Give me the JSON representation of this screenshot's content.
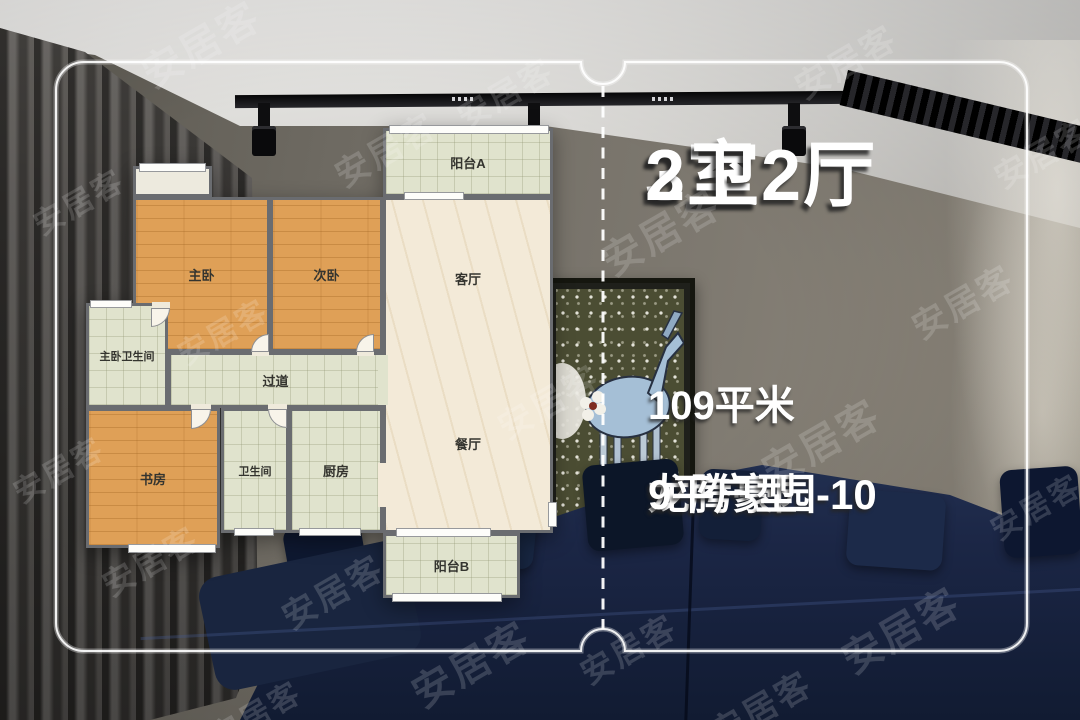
{
  "listing": {
    "title_line1": "3室2厅",
    "title_line2": "2卫",
    "area": "109平米",
    "estate_name_line1": "龙腾豪园-10",
    "estate_name_line2": "9平户型",
    "full_name": "龙腾豪园-109平户型"
  },
  "floorplan": {
    "rooms": [
      {
        "id": "balcony-a",
        "label": "阳台A"
      },
      {
        "id": "living-room",
        "label": "客厅"
      },
      {
        "id": "dining-room",
        "label": "餐厅"
      },
      {
        "id": "master-bedroom",
        "label": "主卧"
      },
      {
        "id": "second-bedroom",
        "label": "次卧"
      },
      {
        "id": "master-bathroom",
        "label": "主卧卫生间"
      },
      {
        "id": "hallway",
        "label": "过道"
      },
      {
        "id": "study",
        "label": "书房"
      },
      {
        "id": "bathroom",
        "label": "卫生间"
      },
      {
        "id": "kitchen",
        "label": "厨房"
      },
      {
        "id": "balcony-b",
        "label": "阳台B"
      }
    ]
  },
  "watermark": {
    "text": "安居客"
  },
  "colors": {
    "wood_floor": "#dfa057",
    "tile_floor": "#e0e3cd",
    "marble_floor": "#f3ead8",
    "plan_wall": "#6a6c70",
    "sofa_navy": "#1b2745",
    "info_text": "#ffffff"
  }
}
